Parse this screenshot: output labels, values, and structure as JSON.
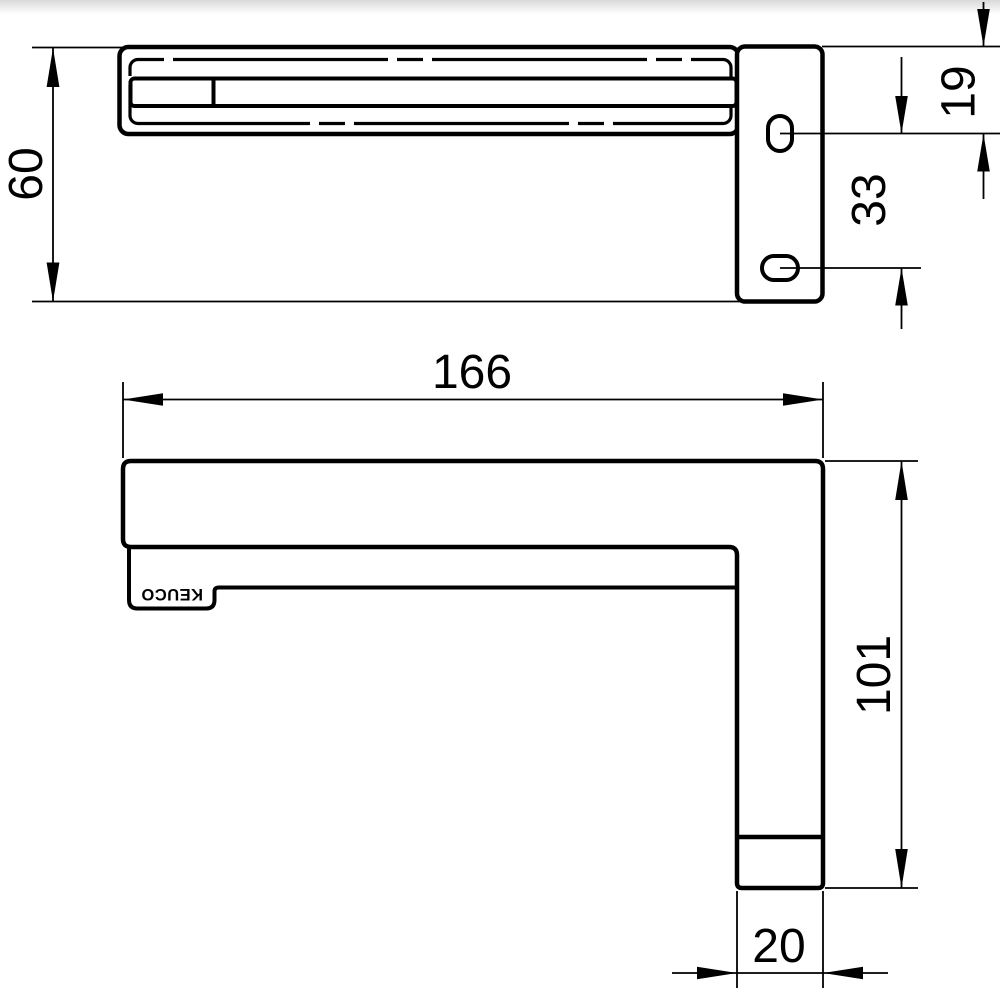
{
  "drawing": {
    "brand": "KEUCO",
    "line_color": "#000000",
    "background_color": "#ffffff",
    "top_shadow_color": "#d9d9d9",
    "views": {
      "top_view": {
        "dimensions": {
          "depth": "60",
          "hole_offset_from_top": "19",
          "hole_spacing": "33"
        }
      },
      "side_view": {
        "brand_label": "KEUCO",
        "dimensions": {
          "length": "166",
          "height": "101",
          "leg_width": "20"
        }
      }
    }
  }
}
